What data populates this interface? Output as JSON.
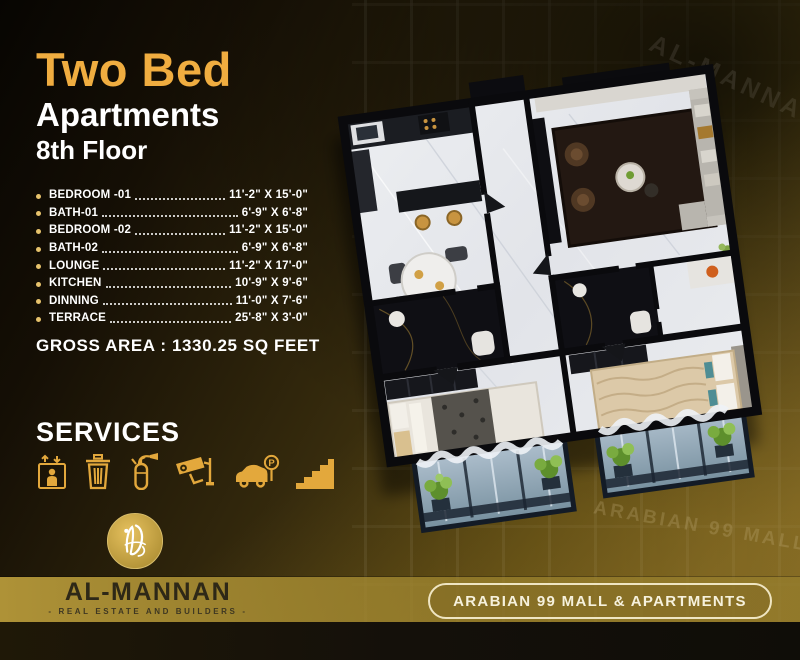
{
  "title": {
    "line1": "Two Bed",
    "line2": "Apartments",
    "line3": "8th Floor"
  },
  "rooms": [
    {
      "label": "BEDROOM -01",
      "size": "11'-2\" X 15'-0\""
    },
    {
      "label": "BATH-01",
      "size": "6'-9\" X 6'-8\""
    },
    {
      "label": "BEDROOM -02",
      "size": "11'-2\" X 15'-0\""
    },
    {
      "label": "BATH-02",
      "size": "6'-9\" X 6'-8\""
    },
    {
      "label": "LOUNGE",
      "size": "11'-2\" X 17'-0\""
    },
    {
      "label": "KITCHEN",
      "size": "10'-9\" X 9'-6\""
    },
    {
      "label": "DINNING",
      "size": "11'-0\" X 7'-6\""
    },
    {
      "label": "TERRACE",
      "size": "25'-8\" X 3'-0\""
    }
  ],
  "gross_area": "GROSS AREA : 1330.25 SQ FEET",
  "services": {
    "heading": "SERVICES",
    "items": [
      {
        "name": "elevator"
      },
      {
        "name": "trash-bin"
      },
      {
        "name": "fire-extinguisher"
      },
      {
        "name": "cctv-camera"
      },
      {
        "name": "car-parking",
        "glyph": "P"
      },
      {
        "name": "stairs"
      }
    ]
  },
  "brand": {
    "name": "AL-MANNAN",
    "tagline": "- REAL ESTATE AND BUILDERS -"
  },
  "badge": {
    "label": "ARABIAN 99 MALL & APARTMENTS"
  },
  "watermarks": {
    "top_right": "AL-MANNAN",
    "bottom_right": "ARABIAN 99 MALL"
  },
  "colors": {
    "accent_gold": "#F0AD40",
    "icon_gold": "#E3A83C",
    "band_gold": "#A78C32",
    "brand_text_dark": "#2E2817",
    "badge_border": "#EFE5C2",
    "badge_text": "#F6F1DC",
    "background_dark": "#0B0903",
    "background_gold": "#6E5A1C",
    "text_white": "#FFFFFF"
  }
}
